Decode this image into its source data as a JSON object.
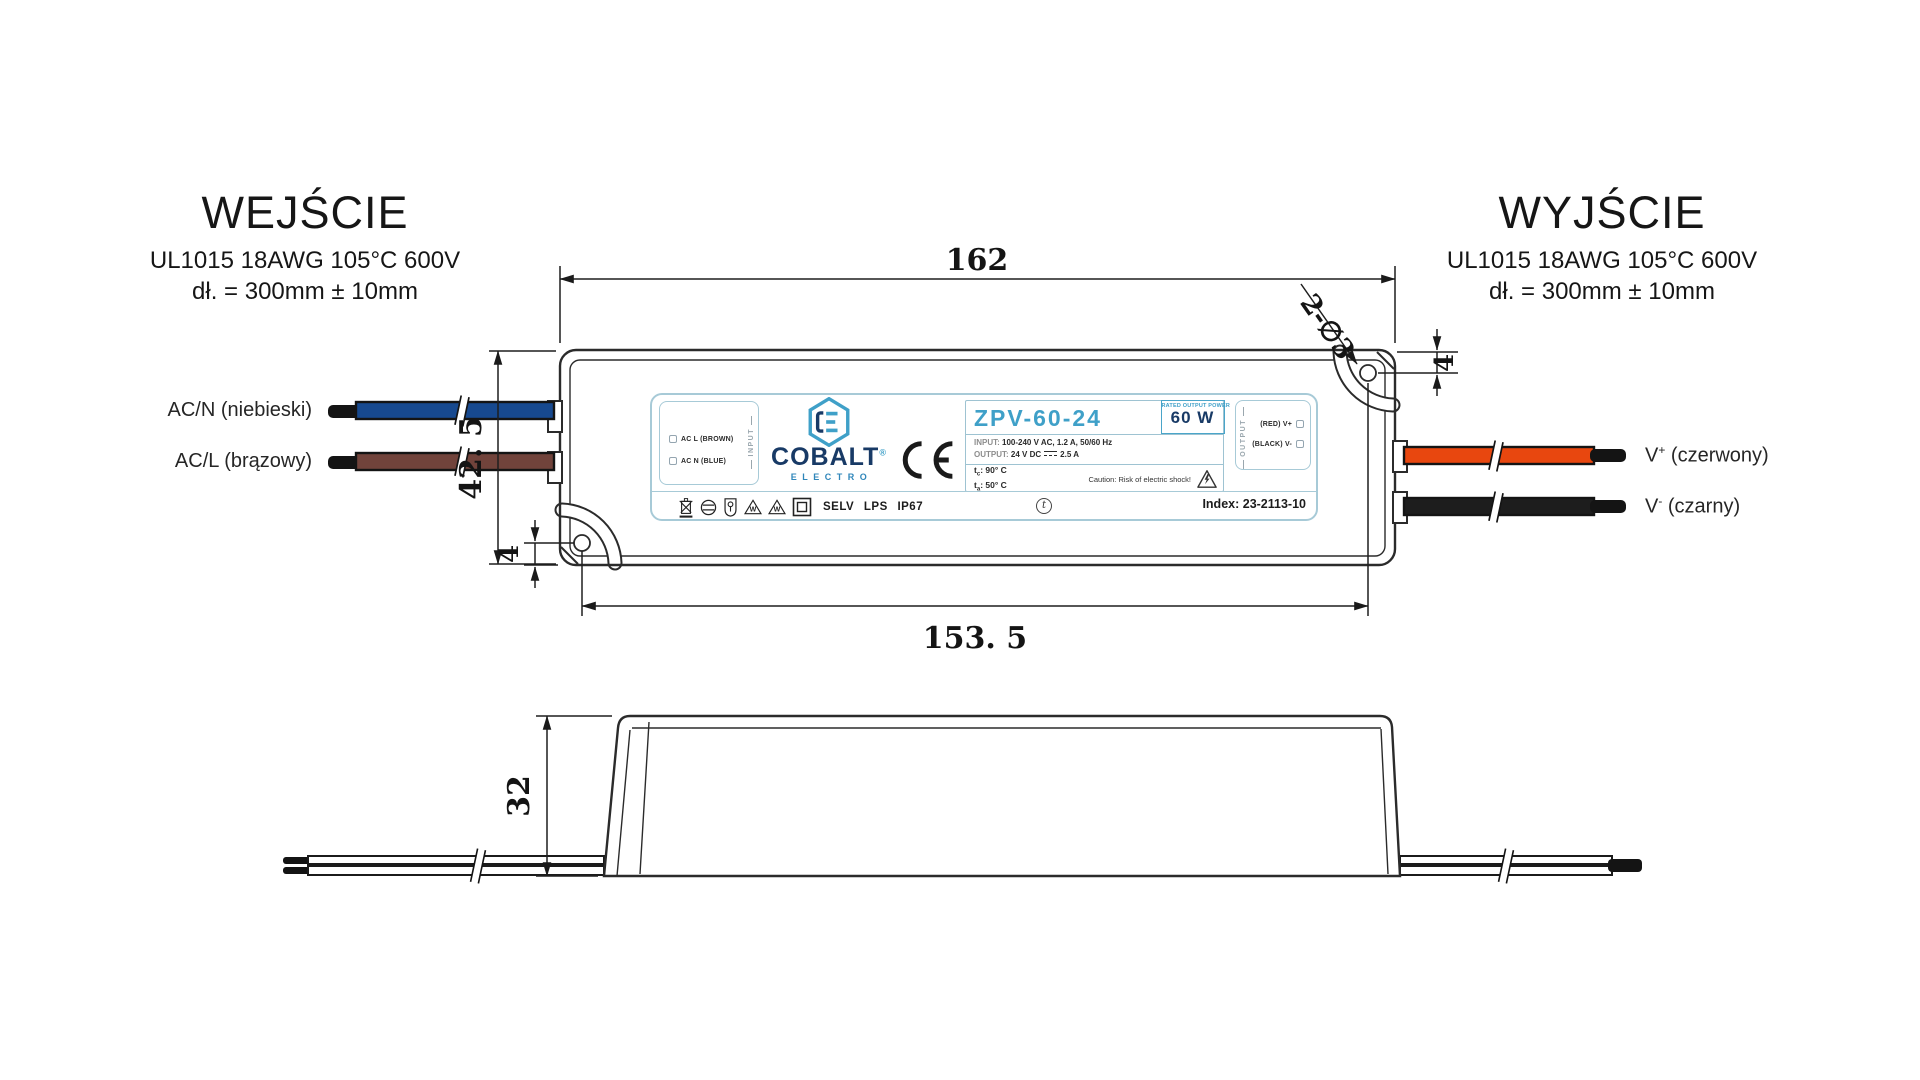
{
  "header_left": {
    "title": "WEJŚCIE",
    "wire_spec": "UL1015 18AWG 105°C 600V",
    "length_spec": "dł. = 300mm ± 10mm"
  },
  "header_right": {
    "title": "WYJŚCIE",
    "wire_spec": "UL1015 18AWG 105°C 600V",
    "length_spec": "dł. = 300mm ± 10mm"
  },
  "wire_labels": {
    "ac_n": {
      "base": "AC/N",
      "suffix": " (niebieski)"
    },
    "ac_l": {
      "base": "AC/L",
      "suffix": " (brązowy)"
    },
    "v_plus": {
      "base": "V",
      "sup": "+",
      "suffix": " (czerwony)"
    },
    "v_minus": {
      "base": "V",
      "sup": "-",
      "suffix": " (czarny)"
    }
  },
  "dimensions": {
    "top_width": "162",
    "left_height": "42. 5",
    "hole_note": "2-∅3",
    "hole_offset_top_right": "4",
    "hole_offset_bottom_left": "4",
    "hole_spacing": "153. 5",
    "side_height": "32"
  },
  "label": {
    "input_box": {
      "line1": "AC L (BROWN)",
      "line2": "AC N (BLUE)",
      "vertical": "INPUT"
    },
    "brand": {
      "name": "COBALT",
      "reg": "®",
      "subname": "ELECTRO"
    },
    "ce_mark": "CE",
    "model": "ZPV-60-24",
    "rated": {
      "caption": "RATED OUTPUT POWER",
      "value": "60 W"
    },
    "specs": {
      "input_label": "INPUT:",
      "input_value": "100-240 V AC, 1.2 A, 50/60 Hz",
      "output_label": "OUTPUT:",
      "output_value_a": "24 V DC",
      "output_value_b": "2.5 A"
    },
    "temps": {
      "tc_base": "t",
      "tc_sub": "c",
      "tc_value": ": 90° C",
      "ta_base": "t",
      "ta_sub": "a",
      "ta_value": ": 50° C"
    },
    "caution": "Caution: Risk of electric shock!",
    "output_box": {
      "vertical": "OUTPUT",
      "line1": "(RED) V+",
      "line2": "(BLACK) V-"
    },
    "certifications": "SELV LPS IP67",
    "t_mark": "t",
    "index": "Index: 23-2113-10"
  },
  "colors": {
    "brand_blue": "#3fa0c8",
    "brand_navy": "#183a66",
    "label_border": "#a7cad7",
    "wire_blue": "#17498f",
    "wire_brown": "#71433b",
    "wire_red": "#e8470f",
    "wire_black": "#1a1a1a",
    "line": "#2b2b2b"
  }
}
